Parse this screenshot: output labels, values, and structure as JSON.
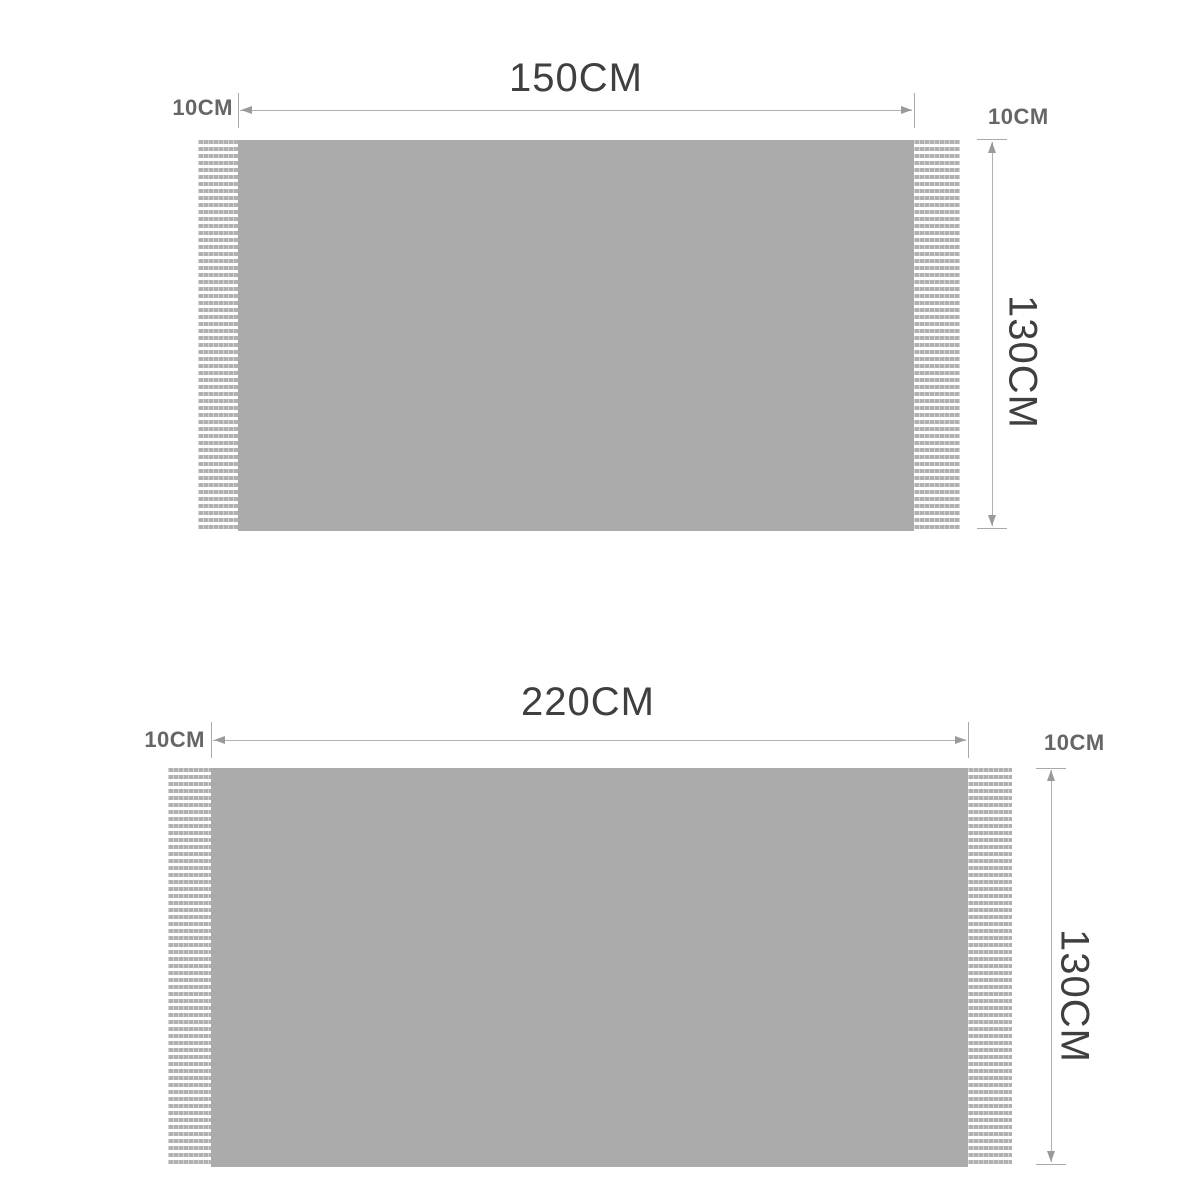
{
  "canvas": {
    "background": "#ffffff"
  },
  "colors": {
    "blanket_body": "#ababab",
    "fringe_stripe": "#b1b1b1",
    "dimension_line": "#b0b0b0",
    "arrowhead": "#9a9a9a",
    "label_large_text": "#3f3f3f",
    "label_small_text": "#666666"
  },
  "diagrams": [
    {
      "id": "blanket-150x130",
      "width_label": "150CM",
      "left_fringe_label": "10CM",
      "right_fringe_label": "10CM",
      "height_label": "130CM"
    },
    {
      "id": "blanket-220x130",
      "width_label": "220CM",
      "left_fringe_label": "10CM",
      "right_fringe_label": "10CM",
      "height_label": "130CM"
    }
  ]
}
